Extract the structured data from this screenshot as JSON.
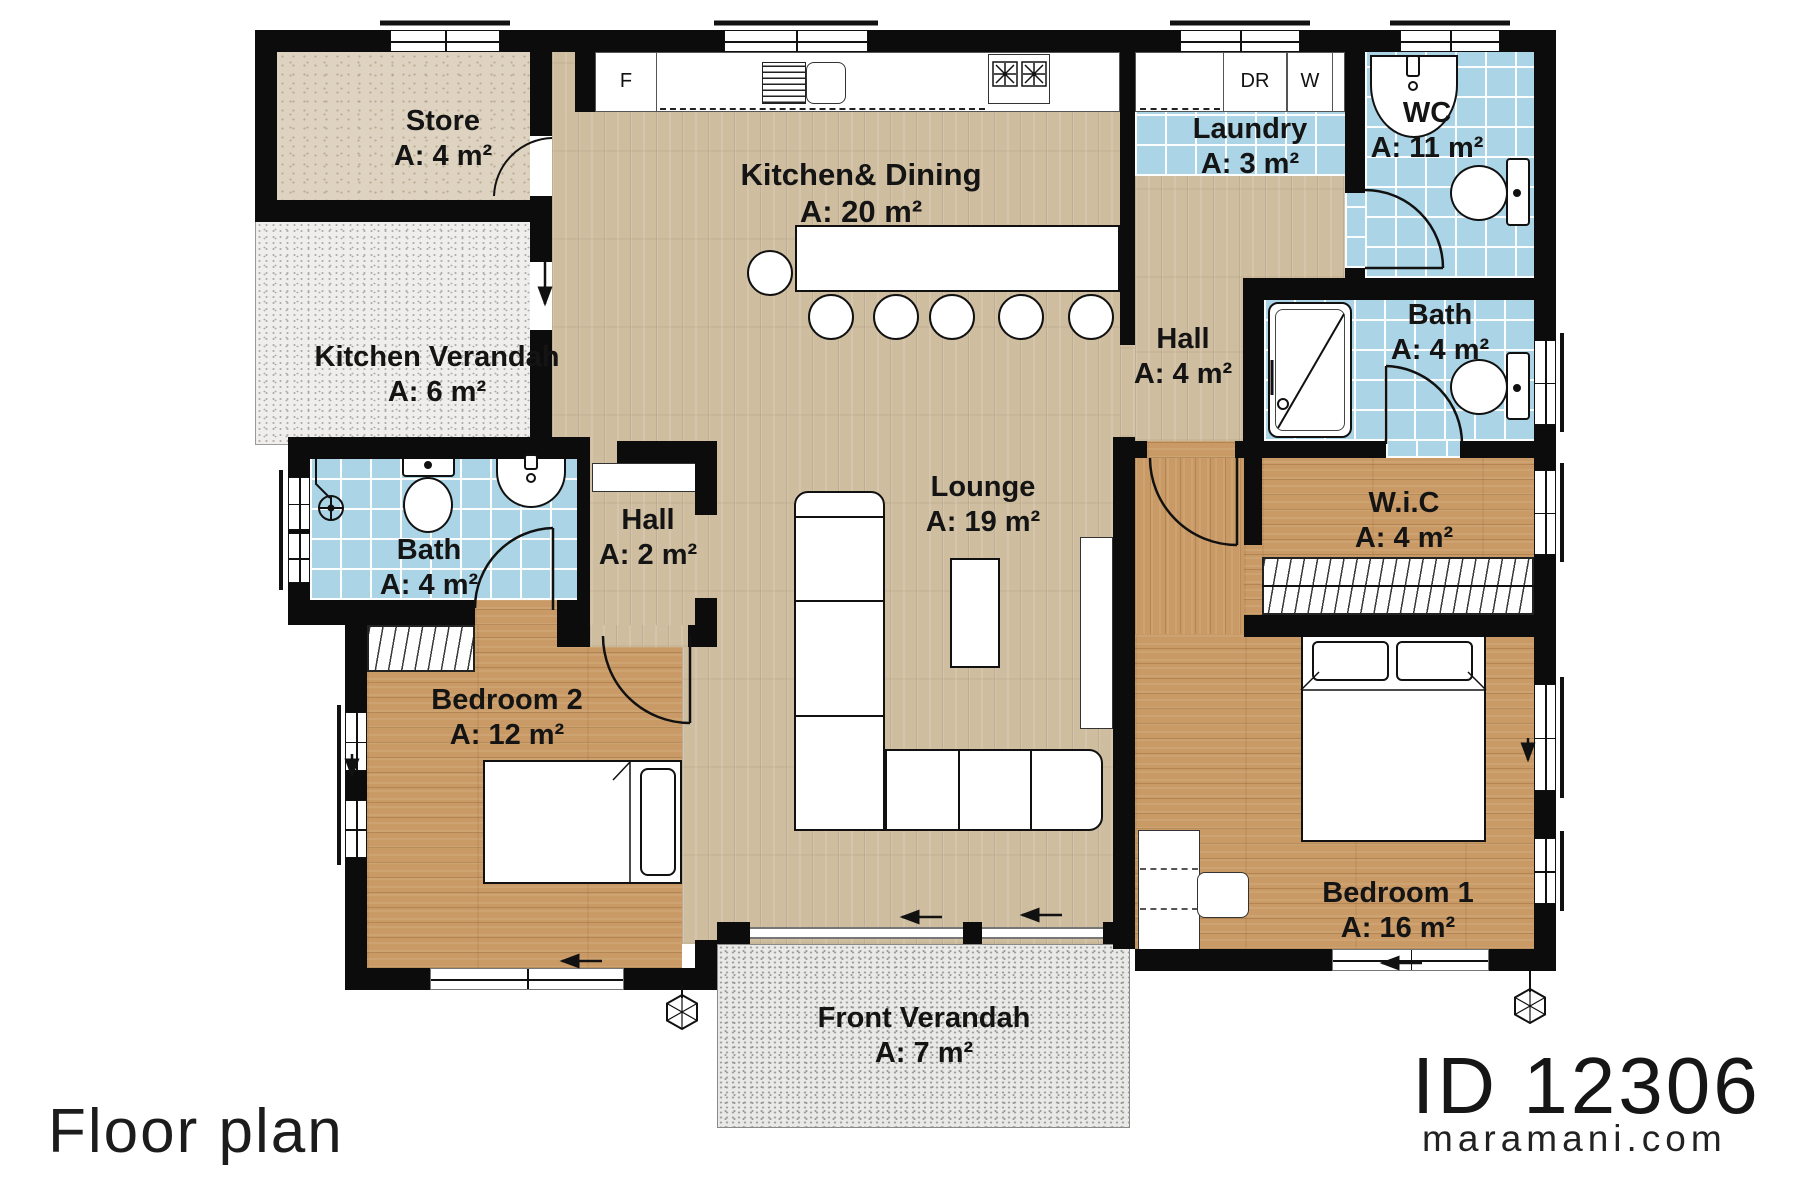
{
  "footer": {
    "title": "Floor plan",
    "plan_id": "ID 12306",
    "website": "maramani.com"
  },
  "rooms": {
    "store": {
      "name": "Store",
      "area": "A: 4 m²"
    },
    "kitchen_verandah": {
      "name": "Kitchen Verandah",
      "area": "A: 6 m²"
    },
    "kitchen_dining": {
      "name": "Kitchen& Dining",
      "area": "A: 20 m²"
    },
    "laundry": {
      "name": "Laundry",
      "area": "A: 3 m²"
    },
    "wc": {
      "name": "WC",
      "area": "A: 11 m²"
    },
    "bath_right": {
      "name": "Bath",
      "area": "A: 4 m²"
    },
    "hall_right": {
      "name": "Hall",
      "area": "A: 4 m²"
    },
    "wic": {
      "name": "W.i.C",
      "area": "A: 4 m²"
    },
    "bath_left": {
      "name": "Bath",
      "area": "A: 4 m²"
    },
    "hall_left": {
      "name": "Hall",
      "area": "A: 2 m²"
    },
    "lounge": {
      "name": "Lounge",
      "area": "A: 19 m²"
    },
    "bedroom2": {
      "name": "Bedroom 2",
      "area": "A: 12 m²"
    },
    "bedroom1": {
      "name": "Bedroom 1",
      "area": "A: 16 m²"
    },
    "front_verandah": {
      "name": "Front Verandah",
      "area": "A: 7 m²"
    }
  },
  "appliances": {
    "fridge": "F",
    "dryer": "DR",
    "washer": "W"
  },
  "colors": {
    "wall": "#0c0c0c",
    "tile_blue": "#abd5e6",
    "wood_light": "#cfbda0",
    "wood_warm": "#c99a66",
    "store_tile": "#ded3c0",
    "verandah": "#e9e9e7"
  }
}
